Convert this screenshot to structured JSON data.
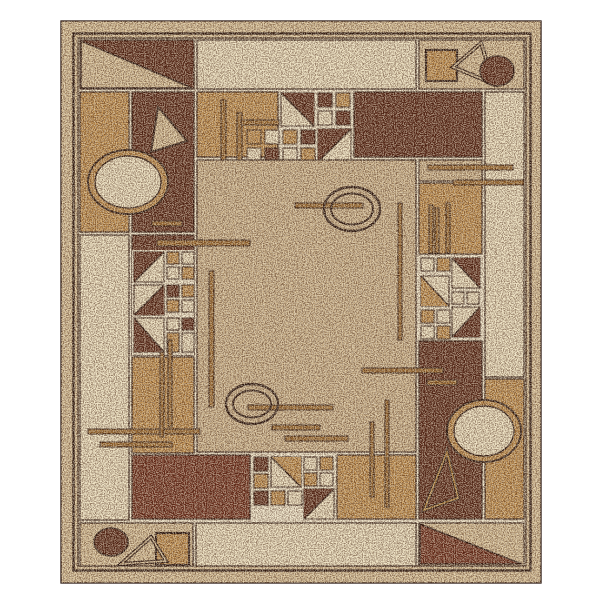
{
  "figure": {
    "alt": "Product photo of a rectangular beige, tan and brown area rug with a Bauhaus style geometric pattern: corner triangles, circles, ovals, squares, thin accent bars and mosaic grids of small squares, on a white background"
  },
  "palette": {
    "page_bg": "#ffffff",
    "border_beige": "#d6bf96",
    "cream": "#ece0c0",
    "gold": "#bf8e4d",
    "field_tan": "#cdb48c",
    "dark_brown": "#5a2a1a",
    "maroon": "#6e2f1e",
    "line": "#2a1710",
    "grout": "#f0e7cd",
    "bar": "#9c6b30",
    "ring_gold": "#b8863c",
    "speckle_dark": "#3f1f0e",
    "speckle_light": "#f7eed6"
  }
}
